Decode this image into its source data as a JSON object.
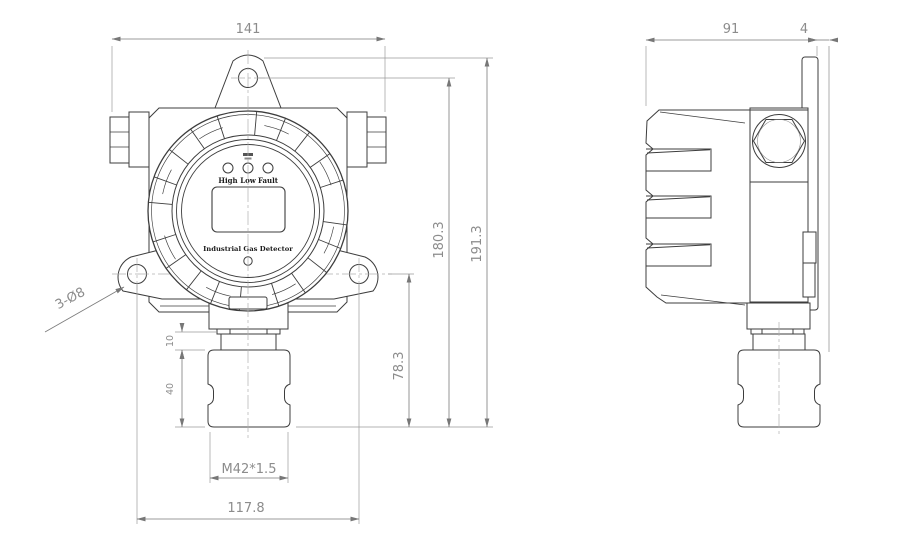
{
  "dims": {
    "front": {
      "width": "141",
      "hole_span": "117.8",
      "thread": "M42*1.5",
      "neck": "10",
      "sensor": "40",
      "drop": "78.3",
      "hole_to_bottom": "180.3",
      "height": "191.3",
      "holes": "3-Ø8"
    },
    "side": {
      "depth": "91",
      "plate": "4"
    }
  },
  "device": {
    "leds": [
      "High",
      "Low",
      "Fault"
    ],
    "caption": "Industrial Gas Detector"
  }
}
